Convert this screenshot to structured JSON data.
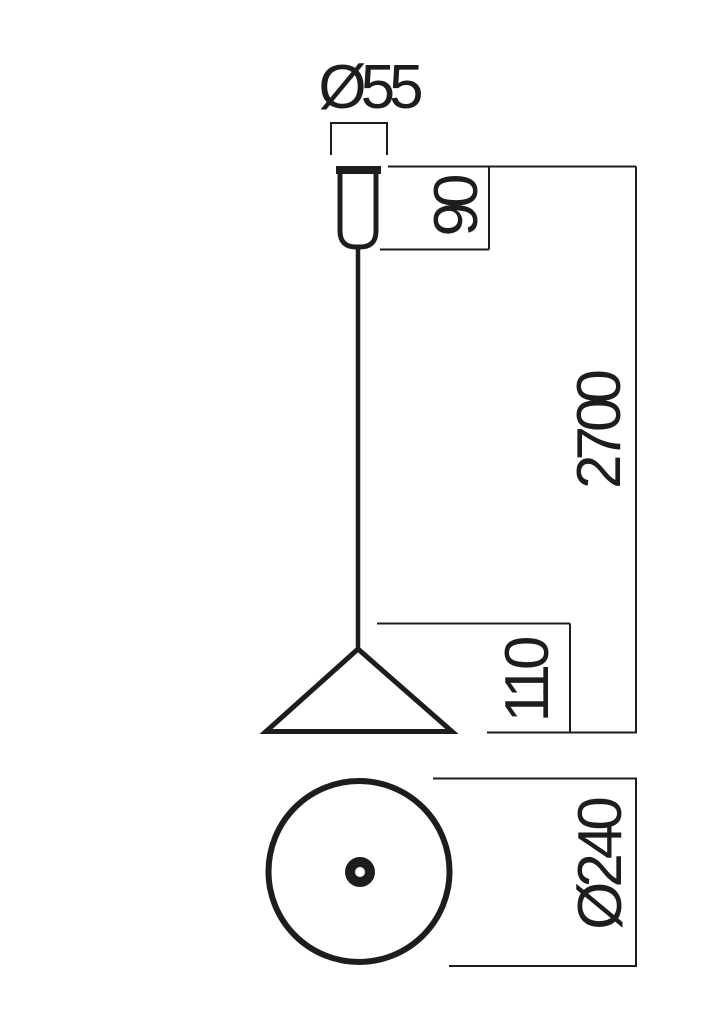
{
  "drawing": {
    "background": "#ffffff",
    "line_color": "#1d1d1b",
    "labels": {
      "canopy_diameter": "Ø55",
      "canopy_height": "90",
      "suspension_length": "2700",
      "shade_height": "110",
      "shade_diameter": "Ø240"
    }
  }
}
